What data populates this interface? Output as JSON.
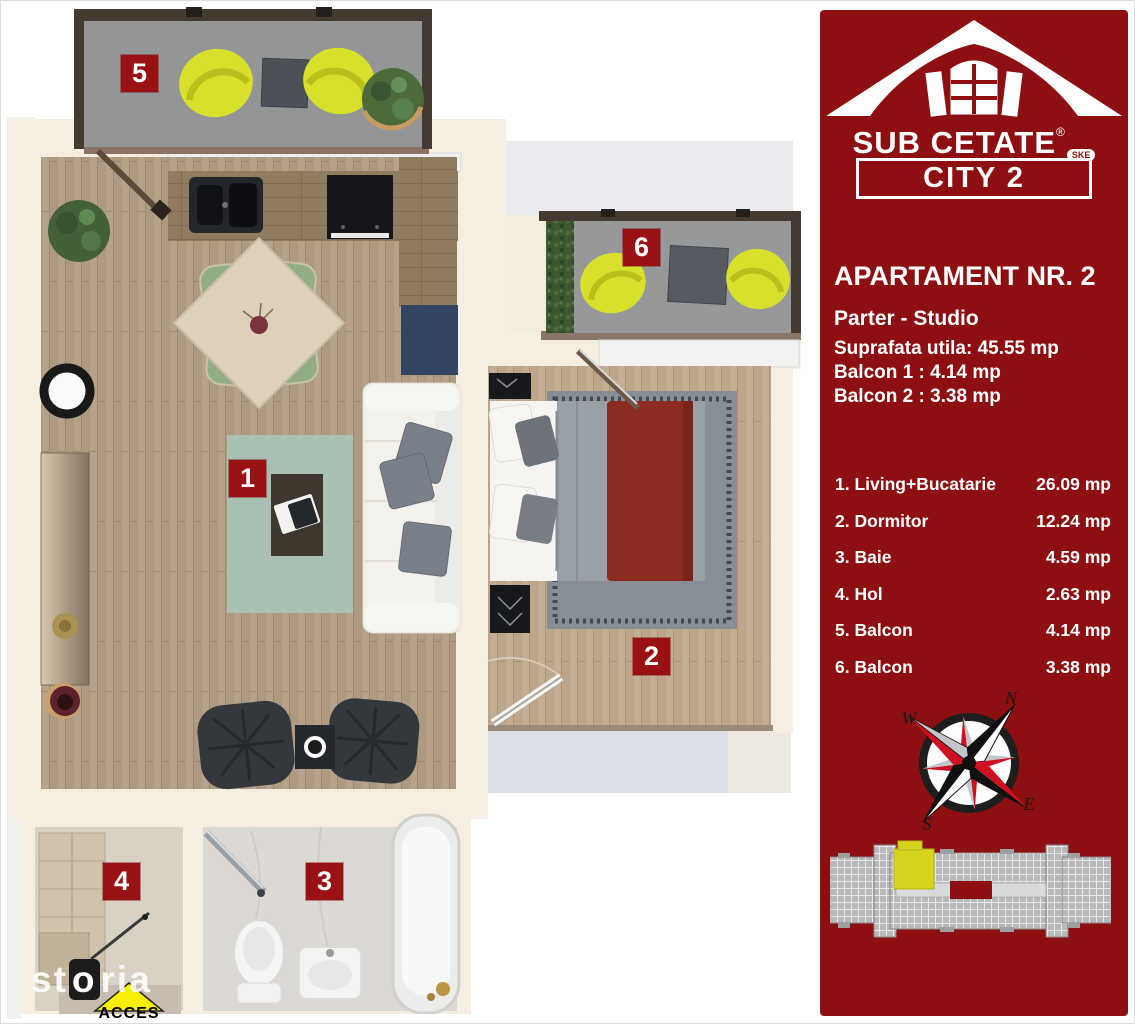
{
  "branding": {
    "name": "SUB CETATE",
    "registered": "®",
    "badge": "SKE",
    "project": "CITY 2"
  },
  "apartment": {
    "title": "APARTAMENT NR. 2",
    "floor": "Parter - Studio",
    "line1": "Suprafata utila: 45.55 mp",
    "line2": "Balcon 1 : 4.14 mp",
    "line3": "Balcon 2 : 3.38 mp"
  },
  "legend": {
    "rooms": [
      {
        "label": "1. Living+Bucatarie",
        "area": "26.09 mp"
      },
      {
        "label": "2. Dormitor",
        "area": "12.24 mp"
      },
      {
        "label": "3. Baie",
        "area": "4.59 mp"
      },
      {
        "label": "4. Hol",
        "area": "2.63 mp"
      },
      {
        "label": "5. Balcon",
        "area": "4.14 mp"
      },
      {
        "label": "6. Balcon",
        "area": "3.38 mp"
      }
    ]
  },
  "plan": {
    "badges": {
      "b1": "1",
      "b2": "2",
      "b3": "3",
      "b4": "4",
      "b5": "5",
      "b6": "6"
    },
    "access": "ACCES"
  },
  "compass": {
    "n": "N",
    "e": "E",
    "s": "S",
    "w": "W"
  },
  "watermark": {
    "pre": "st",
    "o": "o",
    "post": "ria"
  },
  "colors": {
    "sidebar_red": "#8E0F11",
    "badge_red": "#9A1113",
    "chair_yellow": "#D9E02C",
    "unit_yellow": "#D6D51D",
    "rug_sage": "#A9BFB1",
    "throw_red": "#8C2B1F"
  }
}
